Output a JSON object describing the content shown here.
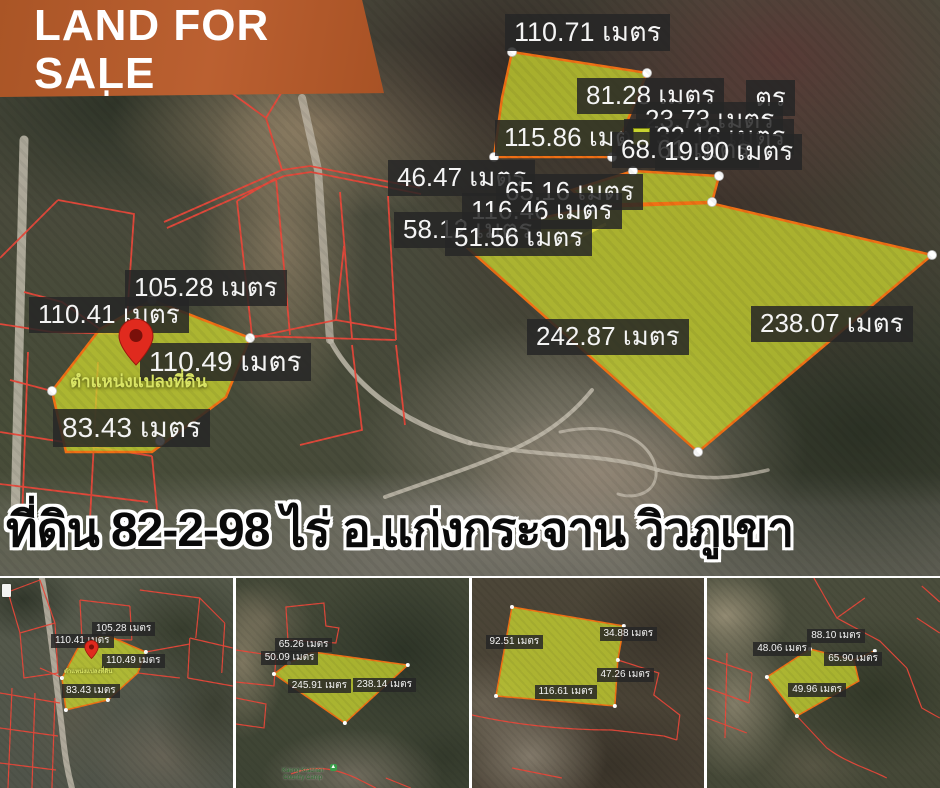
{
  "banner": {
    "title": "LAND FOR SALE",
    "phone": "นัดดูที่ 094-419-6696"
  },
  "headline": "ที่ดิน 82-2-98 ไร่ อ.แก่งกระจาน วิวภูเขา",
  "colors": {
    "banner_bg": "#b35a2a",
    "plot_fill": "#c8d430",
    "plot_stroke": "#f07015",
    "cadastral_red": "#e8483a",
    "label_bg": "#262626",
    "pin_red": "#e02a1e",
    "pin_label_color": "#d9e464",
    "poi_green": "#2d6a2d"
  },
  "main_map": {
    "pin_label": "ตำแหน่งแปลงที่ดิน",
    "labels": [
      {
        "text": "110.71 เมตร",
        "x": 505,
        "y": 14,
        "fs": 27
      },
      {
        "text": "81.28 เมตร",
        "x": 577,
        "y": 78
      },
      {
        "text": "ตร",
        "x": 746,
        "y": 80
      },
      {
        "text": "23.73 เมตร",
        "x": 636,
        "y": 102
      },
      {
        "text": "115.86 เมตร",
        "x": 495,
        "y": 120
      },
      {
        "text": "32.18 เมตร",
        "x": 624,
        "y": 119,
        "swatch": true
      },
      {
        "text": "68.61 เมตร",
        "x": 612,
        "y": 132
      },
      {
        "text": "19.90 เมตร",
        "x": 655,
        "y": 134
      },
      {
        "text": "46.47 เมตร",
        "x": 388,
        "y": 160
      },
      {
        "text": "65.16 เมตร",
        "x": 496,
        "y": 174
      },
      {
        "text": "116.46 เมตร",
        "x": 462,
        "y": 193
      },
      {
        "text": "58.12 เมตร",
        "x": 394,
        "y": 212
      },
      {
        "text": "51.56 เมตร",
        "x": 445,
        "y": 220
      },
      {
        "text": "105.28 เมตร",
        "x": 125,
        "y": 270
      },
      {
        "text": "110.41 เมตร",
        "x": 29,
        "y": 297
      },
      {
        "text": "110.49 เมตร",
        "x": 140,
        "y": 343,
        "fs": 28
      },
      {
        "text": "83.43 เมตร",
        "x": 53,
        "y": 409,
        "fs": 28
      },
      {
        "text": "242.87 เมตร",
        "x": 527,
        "y": 319
      },
      {
        "text": "238.07 เมตร",
        "x": 751,
        "y": 306
      }
    ]
  },
  "thumbnails": [
    {
      "pin_label": "ตำแหน่งแปลงที่ดิน",
      "labels": [
        {
          "text": "105.28 เมตร",
          "x": 92,
          "y": 44
        },
        {
          "text": "110.41 เมตร",
          "x": 51,
          "y": 56
        },
        {
          "text": "110.49 เมตร",
          "x": 102,
          "y": 76
        },
        {
          "text": "83.43 เมตร",
          "x": 62,
          "y": 106
        }
      ]
    },
    {
      "poi": "Kaeng Krachan Country Camp",
      "labels": [
        {
          "text": "65.26 เมตร",
          "x": 39,
          "y": 60
        },
        {
          "text": "50.09 เมตร",
          "x": 25,
          "y": 73
        },
        {
          "text": "245.91 เมตร",
          "x": 52,
          "y": 101
        },
        {
          "text": "238.14 เมตร",
          "x": 117,
          "y": 100
        }
      ]
    },
    {
      "labels": [
        {
          "text": "92.51 เมตร",
          "x": 14,
          "y": 57
        },
        {
          "text": "34.88 เมตร",
          "x": 128,
          "y": 49
        },
        {
          "text": "47.26 เมตร",
          "x": 125,
          "y": 90
        },
        {
          "text": "116.61 เมตร",
          "x": 63,
          "y": 107
        }
      ]
    },
    {
      "labels": [
        {
          "text": "88.10 เมตร",
          "x": 100,
          "y": 51
        },
        {
          "text": "48.06 เมตร",
          "x": 46,
          "y": 64
        },
        {
          "text": "65.90 เมตร",
          "x": 117,
          "y": 74
        },
        {
          "text": "49.96 เมตร",
          "x": 81,
          "y": 105
        }
      ]
    }
  ]
}
